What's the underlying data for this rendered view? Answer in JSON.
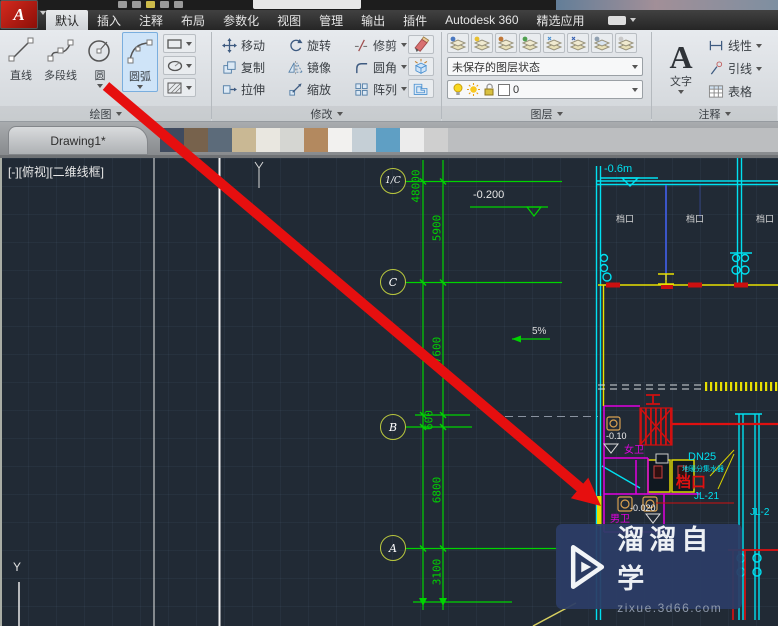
{
  "app": {
    "logo_letter": "A"
  },
  "ribbon_tabs": [
    "默认",
    "插入",
    "注释",
    "布局",
    "参数化",
    "视图",
    "管理",
    "输出",
    "插件",
    "Autodesk 360",
    "精选应用"
  ],
  "draw_panel": {
    "label": "绘图",
    "line": "直线",
    "pline": "多段线",
    "circle": "圆",
    "arc": "圆弧"
  },
  "modify_panel": {
    "label": "修改",
    "move": "移动",
    "rotate": "旋转",
    "trim": "修剪",
    "copy": "复制",
    "mirror": "镜像",
    "fillet": "圆角",
    "stretch": "拉伸",
    "scale": "缩放",
    "array": "阵列"
  },
  "layer_panel": {
    "label": "图层",
    "state": "未保存的图层状态",
    "current": "0"
  },
  "annot_panel": {
    "label": "注释",
    "a": "A",
    "text": "文字",
    "linear": "线性",
    "leader": "引线",
    "table": "表格"
  },
  "file_tab": "Drawing1*",
  "viewport": "[-][俯视][二维线框]",
  "cad": {
    "bubbles": [
      "1/C",
      "C",
      "B",
      "A"
    ],
    "dims": [
      "48000",
      "5900",
      "7600",
      "600",
      "6800",
      "3100"
    ],
    "elev_top": "-0.200",
    "elev_right": "-0.6m",
    "elev_women": "-0.10",
    "elev_men": "-0.020",
    "slope": "5%",
    "stalls": [
      "档口",
      "档口",
      "档口"
    ],
    "women": "女卫",
    "men": "男卫",
    "dn25": "DN25",
    "heating": "地暖分集水器",
    "stall_red": "档口",
    "jl21": "JL-21",
    "jl2": "JL-2",
    "ucs_y": "Y"
  },
  "watermark": {
    "name": "溜溜自学",
    "site": "zixue.3d66.com"
  },
  "colors": {
    "cad_green": "#00d400",
    "cad_cyan": "#00e0f0",
    "cad_yellow": "#e8e000",
    "cad_magenta": "#e000e0",
    "cad_red": "#e01010",
    "arrow_red": "#e60f0f",
    "highlight_blue": "#cfe4f8"
  }
}
